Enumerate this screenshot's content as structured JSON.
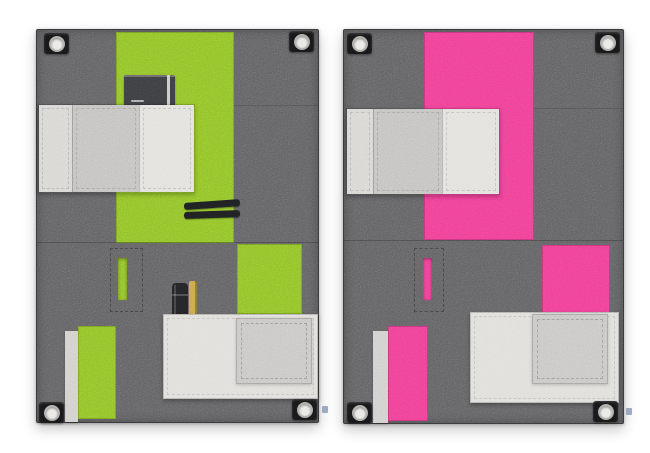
{
  "scene": {
    "name": "two-felt-wall-organizers",
    "left_panel_name": "wall-organizer-green-accent",
    "right_panel_name": "wall-organizer-pink-accent",
    "objects": [
      "notebook",
      "black-marker",
      "gold-pencil",
      "folded-glasses"
    ],
    "grommet_count_per_panel": 4
  },
  "colors": {
    "background": "#ffffff",
    "felt_dark": "#606062",
    "accent_green": "#8dc02a",
    "accent_pink": "#ef3f90",
    "pocket_seg_light": "#d6d5d1",
    "pocket_seg_mid": "#c1c0bd",
    "pocket_seg_lightest": "#e1e0dc",
    "pocket_big_light": "#deddd9",
    "flap_grey": "#c6c5c2",
    "strip_grey": "#cfcecb",
    "leather_black": "#1a1a1c",
    "eyelet_silver": "#eceae7",
    "notebook_dark": "#3b3c40",
    "notebook_band": "#d8d7d1",
    "marker_black": "#232326",
    "pencil_gold": "#c7a24b",
    "glasses_black": "#1e1f21",
    "watermark_grey": "#7f93b2"
  }
}
